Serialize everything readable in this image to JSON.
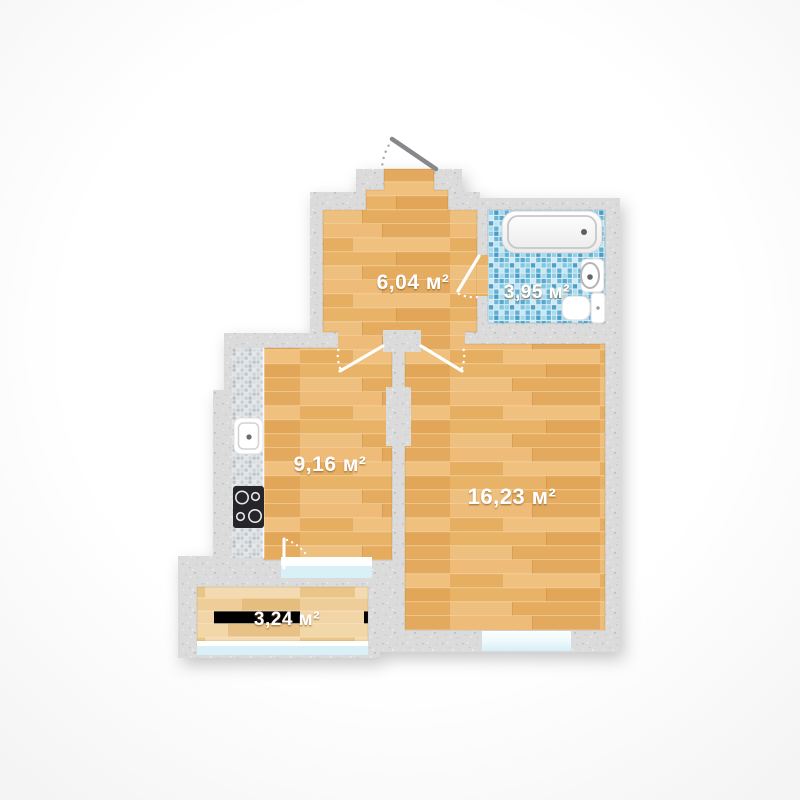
{
  "floor_plan": {
    "rooms": {
      "hallway": {
        "label": "6,04 м²"
      },
      "bathroom": {
        "label": "3,95 м²"
      },
      "kitchen": {
        "label": "9,16 м²"
      },
      "living_room": {
        "label": "16,23 м²"
      },
      "balcony": {
        "label": "3,24 м²"
      }
    },
    "fixtures": {
      "bathtub": "bathtub",
      "washbasin": "washbasin",
      "toilet": "toilet",
      "kitchen_sink": "kitchen-sink",
      "cooktop": "cooktop"
    },
    "colors": {
      "wall": "#dbdbdb",
      "wood": "#e9b269",
      "wood_balcony": "#eccd97",
      "tile_bathroom": "#66b3d6",
      "tile_counter": "#ccd2d6",
      "window_glass": "#dff2f8",
      "entrance_door_leaf": "#86888c",
      "interior_door_leaf": "#ffffff",
      "label_text": "#ffffff"
    }
  }
}
